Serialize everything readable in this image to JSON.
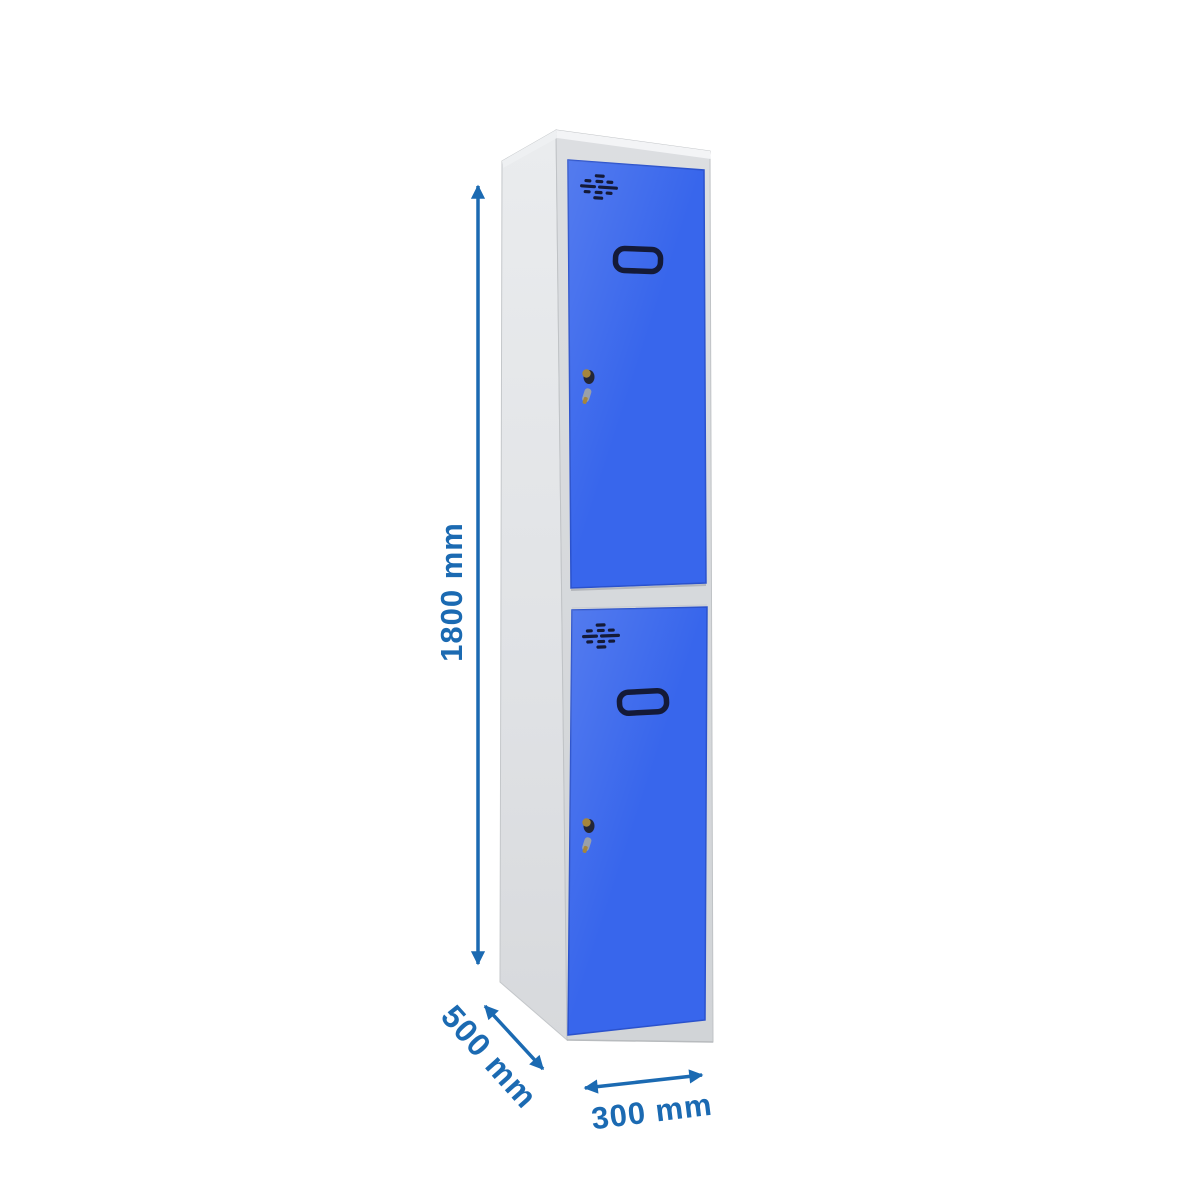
{
  "diagram": {
    "title": "Two-door locker with dimensions",
    "dimensions": {
      "height": {
        "label": "1800 mm",
        "value": 1800,
        "unit": "mm"
      },
      "depth": {
        "label": "500 mm",
        "value": 500,
        "unit": "mm"
      },
      "width": {
        "label": "300 mm",
        "value": 300,
        "unit": "mm"
      }
    },
    "colors": {
      "annotation_blue": "#1B6AB2",
      "door_blue": "#3866EC",
      "door_edge_blue": "#2B52CC",
      "cabinet_grey": "#E3E5E8",
      "frame_grey": "#D8DADD",
      "hardware_navy": "#141A38",
      "key_gold": "#A5853C",
      "background": "#FFFFFF"
    }
  }
}
